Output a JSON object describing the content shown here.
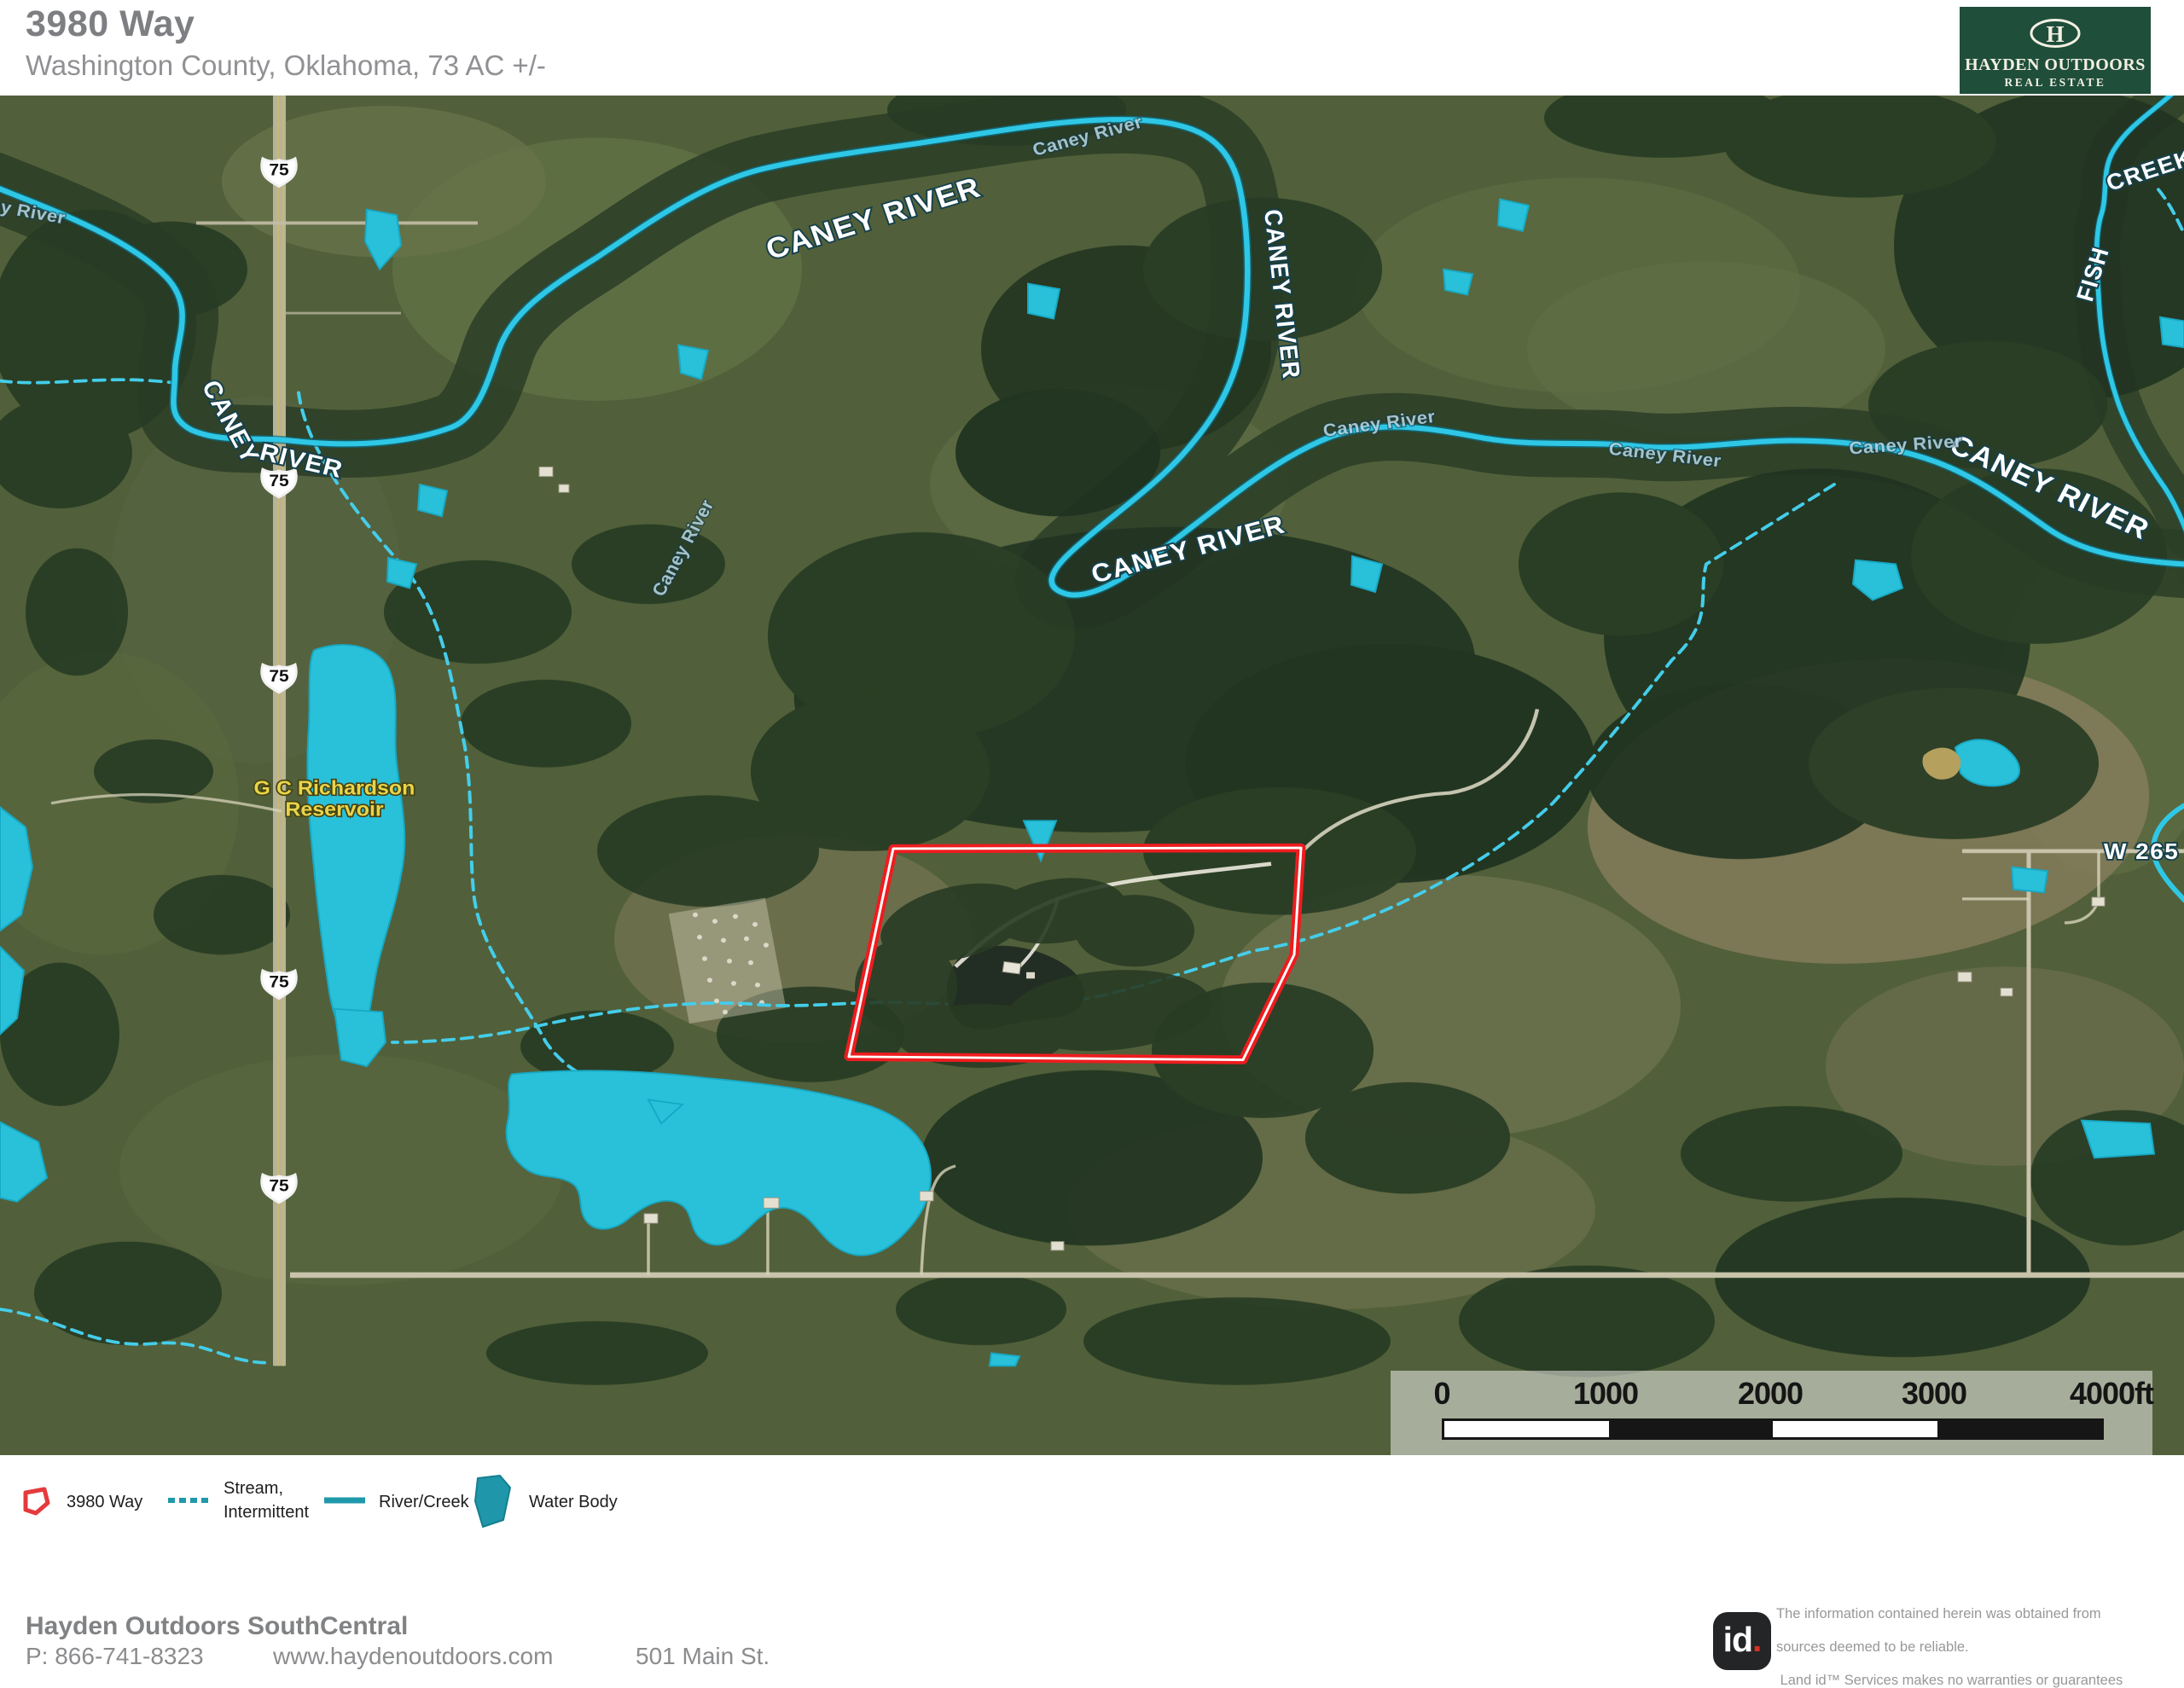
{
  "header": {
    "title": "3980 Way",
    "subtitle": "Washington County, Oklahoma, 73 AC +/-"
  },
  "brand": {
    "monogram": "H",
    "name": "HAYDEN OUTDOORS",
    "tagline": "REAL ESTATE"
  },
  "map": {
    "labels": {
      "highway": "75",
      "caney_river": "CANEY RIVER",
      "caney": "CANEY",
      "river": "RIVER",
      "caney_small": "Caney River",
      "fish": "FISH",
      "creek": "CREEK",
      "reservoir_line1": "G C Richardson",
      "reservoir_line2": "Reservoir",
      "road": "W 265"
    },
    "scale_bar": {
      "ticks": [
        "0",
        "1000",
        "2000",
        "3000",
        "4000ft"
      ]
    }
  },
  "legend": {
    "property": "3980 Way",
    "stream_line1": "Stream,",
    "stream_line2": "Intermittent",
    "river": "River/Creek",
    "water": "Water Body"
  },
  "footer": {
    "office": "Hayden Outdoors SouthCentral",
    "phone": "P: 866-741-8323",
    "website": "www.haydenoutdoors.com",
    "address": "501 Main St."
  },
  "disclaimer": {
    "logo_text": "id",
    "logo_dot": ".",
    "lines": [
      "The information contained herein was obtained from",
      "sources deemed to be reliable.",
      " Land id™ Services makes no warranties or guarantees",
      "as to the completeness or accuracy thereof."
    ]
  },
  "colors": {
    "brand_green": "#1f4e3b",
    "boundary_red": "#ee1c1f",
    "river_cyan": "#2fc7e6",
    "water_teal": "#29c0da",
    "stream_cyan": "#44cdea",
    "legend_teal": "#1f98aa",
    "reservoir_label_yellow": "#e8d44a",
    "field_green": "#51603a",
    "forest_green": "#283b24"
  }
}
